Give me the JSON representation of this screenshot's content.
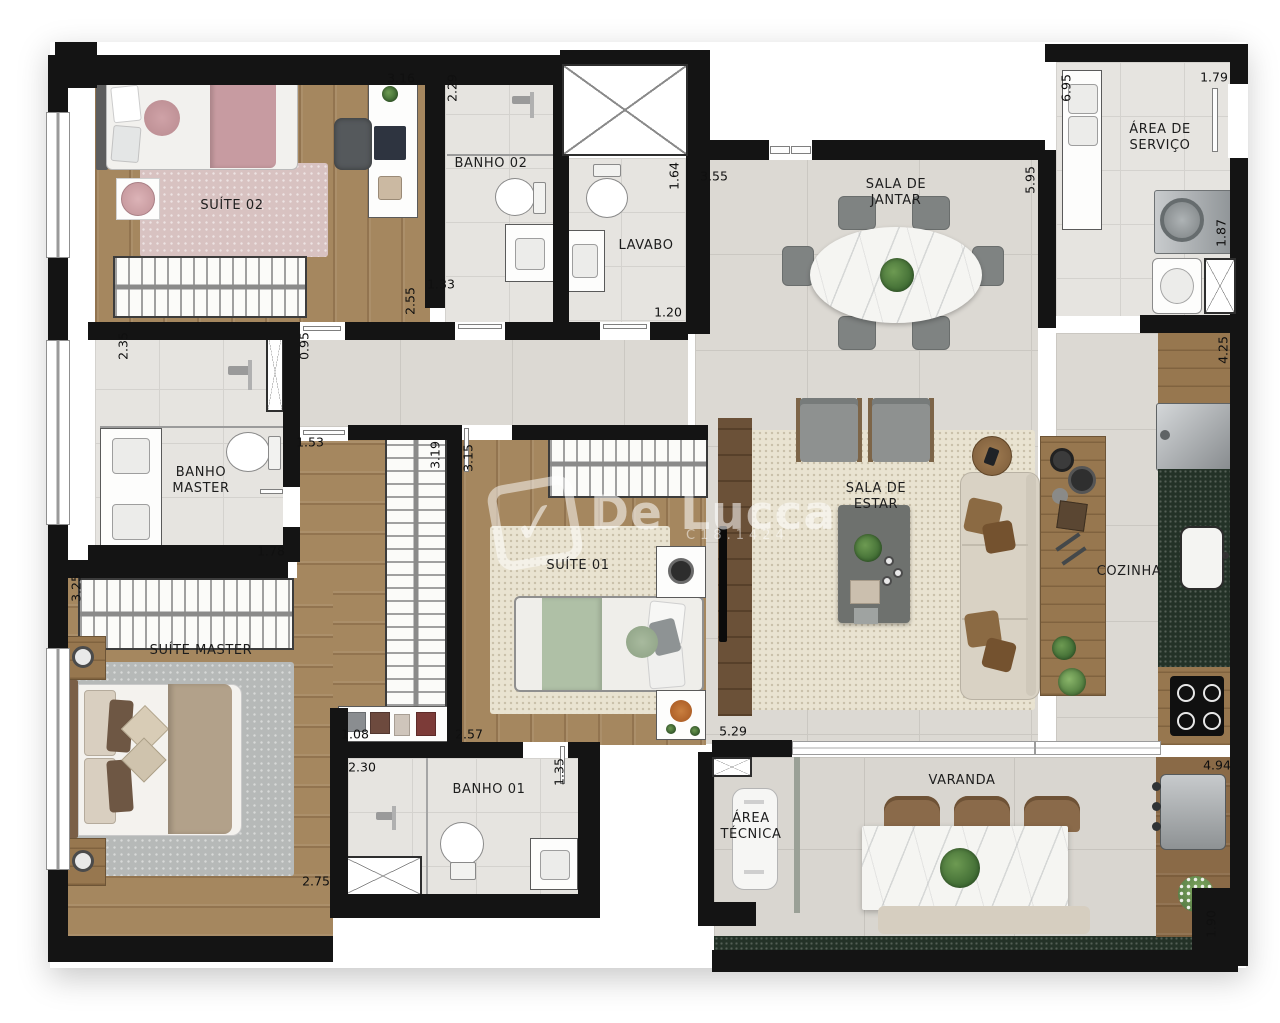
{
  "watermark": {
    "brand": "De Lucca",
    "code": "C18.1424",
    "check": "✓"
  },
  "rooms": {
    "suite02": "SUÍTE 02",
    "banho02": "BANHO 02",
    "lavabo": "LAVABO",
    "sala_jantar": "SALA DE\nJANTAR",
    "area_servico": "ÁREA DE\nSERVIÇO",
    "banho_master": "BANHO\nMASTER",
    "suite_master": "SUÍTE MASTER",
    "suite01": "SUÍTE 01",
    "sala_estar": "SALA DE\nESTAR",
    "cozinha": "COZINHA",
    "banho01": "BANHO 01",
    "area_tecnica": "ÁREA\nTÉCNICA",
    "varanda": "VARANDA"
  },
  "dimensions": {
    "suite02_top": "3.16",
    "banho02_side": "2.29",
    "suite02_side": "2.55",
    "banho02_door": "1.33",
    "lavabo_side": "1.64",
    "lavabo_door": "1.20",
    "jantar_top": "3.55",
    "jantar_side": "5.95",
    "servico_side": "6.95",
    "servico_top": "1.79",
    "servico_right": "1.87",
    "cozinha_side": "4.25",
    "banho_master_side": "2.35",
    "hall_door": "0.95",
    "corredor_door": "1.53",
    "armario_side": "3.19",
    "suite01_side": "3.15",
    "banho_master_door": "1.78",
    "suite_master_side": "3.25",
    "armario_base": "1.08",
    "suite01_base": "2.57",
    "estar_base": "5.29",
    "banho01_top": "2.30",
    "banho01_side": "1.35",
    "suite_master_base": "2.75",
    "varanda_top": "4.94",
    "varanda_side": "1.90"
  }
}
